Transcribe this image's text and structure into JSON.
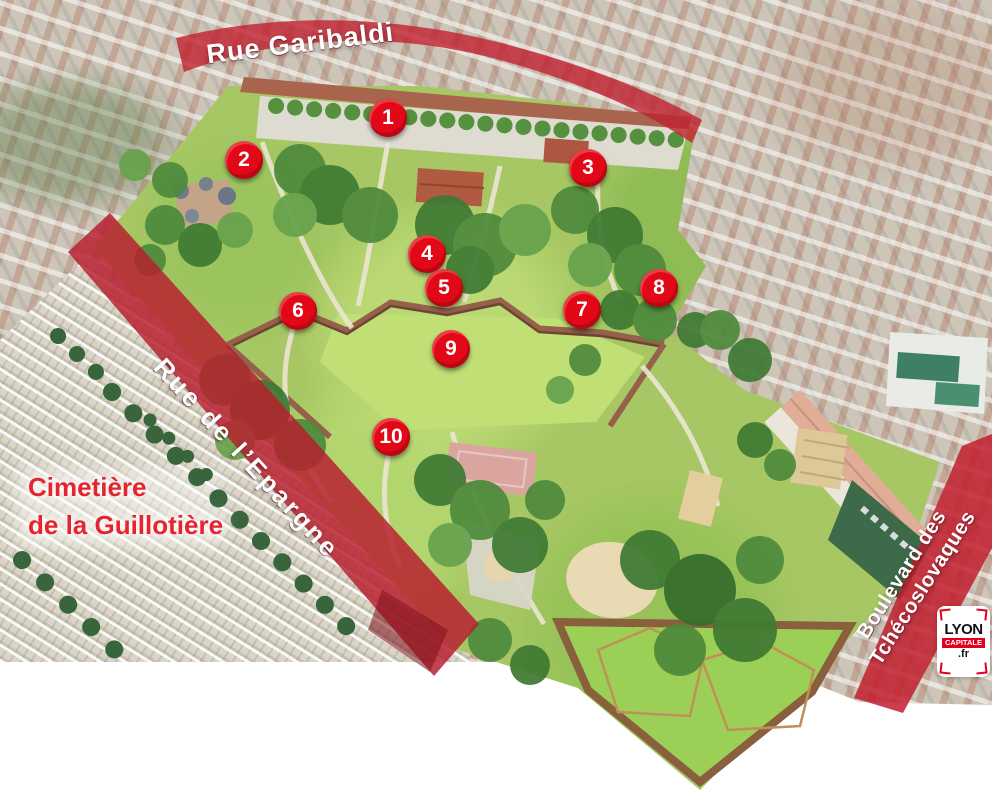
{
  "map": {
    "street_labels": {
      "rue_garibaldi": "Rue Garibaldi",
      "rue_de_lepargne": "Rue de l’Epargne",
      "boulevard_line1": "Boulevard des",
      "boulevard_line2": "Tchécoslovaques"
    },
    "area_labels": {
      "cemetery_line1": "Cimetière",
      "cemetery_line2": "de la Guillotière"
    },
    "markers": [
      {
        "number": "1"
      },
      {
        "number": "2"
      },
      {
        "number": "3"
      },
      {
        "number": "4"
      },
      {
        "number": "5"
      },
      {
        "number": "6"
      },
      {
        "number": "7"
      },
      {
        "number": "8"
      },
      {
        "number": "9"
      },
      {
        "number": "10"
      }
    ],
    "logo": {
      "top": "LYON",
      "middle": "CAPITALE",
      "bottom": ".fr"
    },
    "colors": {
      "road_band_red": "#c1202f",
      "marker_red": "#e20817",
      "cemetery_label_red": "#e62430",
      "logo_red": "#e2001c",
      "park_green": "#a6c763"
    }
  }
}
